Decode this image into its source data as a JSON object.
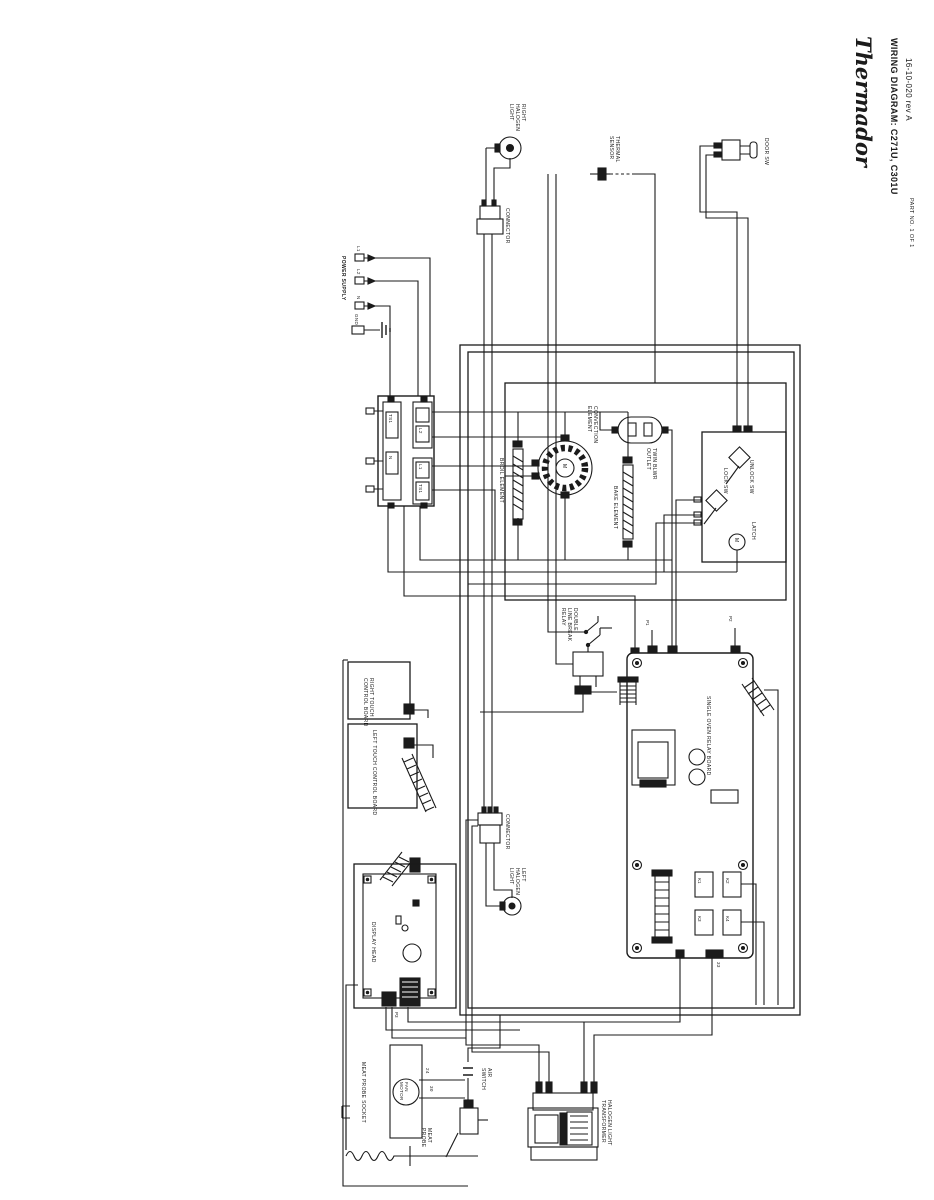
{
  "colors": {
    "ink": "#1b1b1b",
    "paper": "#ffffff"
  },
  "title_block": {
    "brand": "Thermador",
    "doc_title": "WIRING DIAGRAM: C271U, C301U",
    "doc_number": "16-10-020 rev A",
    "page_note": "PART NO. 1 OF 1"
  },
  "power_supply": {
    "label": "POWER SUPPLY",
    "t1": "L1",
    "t2": "L2",
    "t3": "N",
    "t4": "GND"
  },
  "terminal_block": {
    "c1": "TS1",
    "c2": "N",
    "c3": "L2",
    "c4": "L1",
    "c5": "TS1"
  },
  "elements": {
    "broil": "BROIL ELEMENT",
    "convection": "CONVECTION\nELEMENT",
    "motor_symbol": "M",
    "bake": "BAKE ELEMENT",
    "blower": "TWIN BLWR\nOUTLET"
  },
  "latch": {
    "label": "LATCH",
    "lock": "LOCK SW",
    "unlock": "UNLOCK SW",
    "motor": "M"
  },
  "door_switch": {
    "label": "DOOR SW"
  },
  "sensor": {
    "label": "THERMAL\nSENSOR"
  },
  "lights": {
    "right": "RIGHT\nHALOGEN\nLIGHT",
    "left": "LEFT\nHALOGEN\nLIGHT",
    "connector": "CONNECTOR"
  },
  "dlb_relay": {
    "label": "DOUBLE\nLINE BREAK\nRELAY"
  },
  "boards": {
    "right_touch": "RIGHT TOUCH\nCONTROL BOARD",
    "left_touch": "LEFT TOUCH CONTROL BOARD",
    "display": "DISPLAY HEAD",
    "relay": "SINGLE OVEN RELAY BOARD"
  },
  "relay_parts": {
    "k1": "K1",
    "k2": "K2",
    "k3": "K3",
    "k4": "K4",
    "p1": "P1",
    "p2": "P2",
    "p3": "P3"
  },
  "bottom": {
    "transformer": "HALOGEN LIGHT\nTRANSFORMER",
    "probe_socket": "MEAT PROBE SOCKET",
    "probe": "MEAT\nPROBE",
    "fan": "FAN\nMOTOR",
    "air_switch": "AIR\nSWITCH"
  },
  "wire_tags": {
    "w24": "24",
    "w30": "30",
    "w33": "33"
  }
}
